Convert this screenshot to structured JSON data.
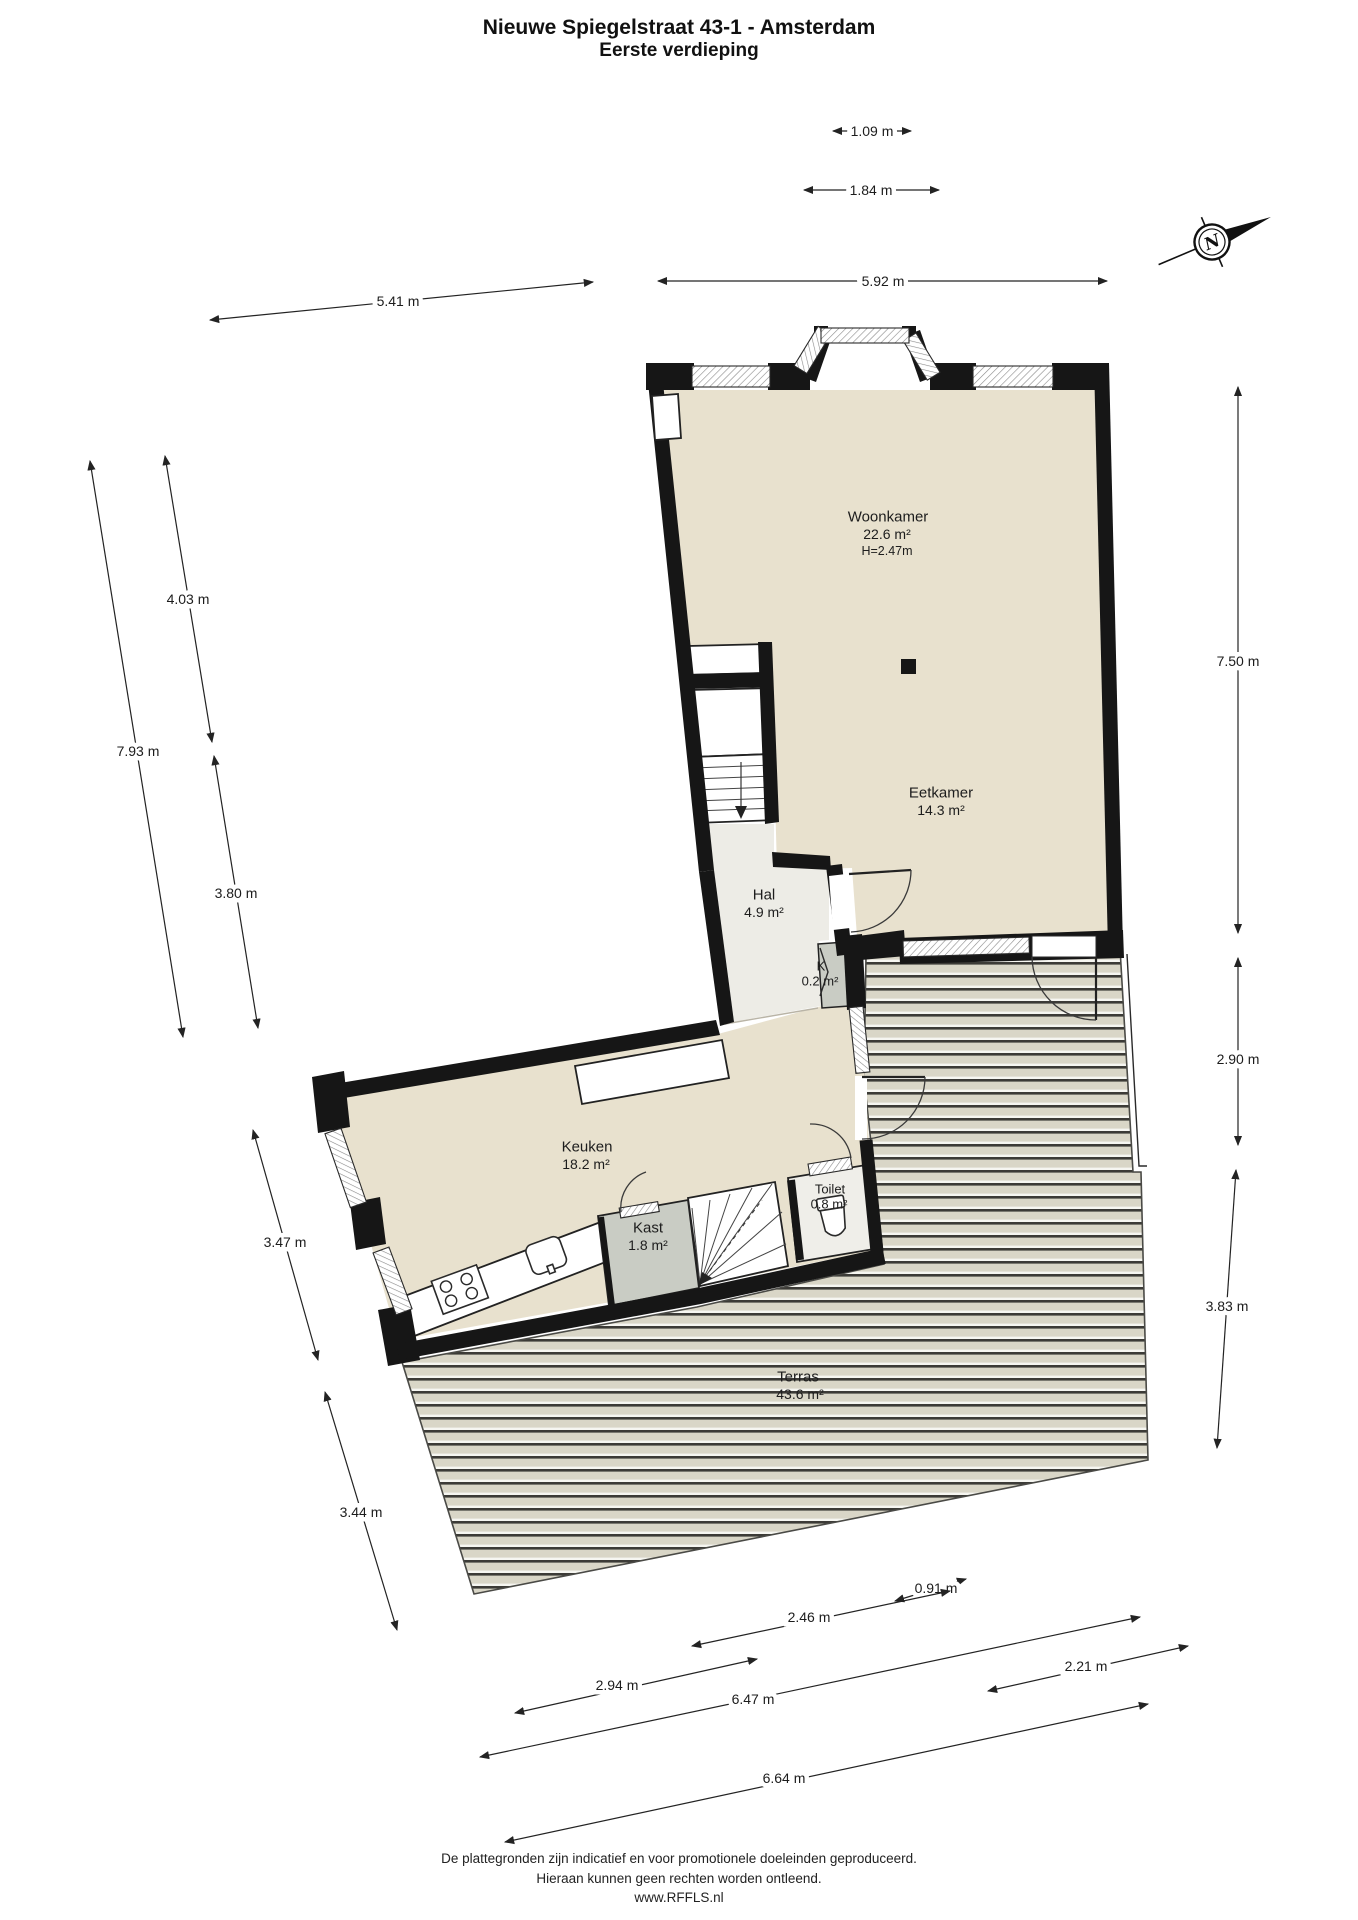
{
  "title": {
    "line1": "Nieuwe Spiegelstraat 43-1 - Amsterdam",
    "line2": "Eerste verdieping"
  },
  "compass": {
    "label": "N"
  },
  "rooms": [
    {
      "name": "Woonkamer",
      "area": "22.6 m²",
      "height": "H=2.47m"
    },
    {
      "name": "Eetkamer",
      "area": "14.3 m²"
    },
    {
      "name": "Hal",
      "area": "4.9 m²"
    },
    {
      "name": "K",
      "area": "0.2 m²"
    },
    {
      "name": "Keuken",
      "area": "18.2 m²"
    },
    {
      "name": "Kast",
      "area": "1.8 m²"
    },
    {
      "name": "Toilet",
      "area": "0.8 m²"
    },
    {
      "name": "Terras",
      "area": "43.6 m²"
    }
  ],
  "dimensions": [
    {
      "label": "1.09 m"
    },
    {
      "label": "1.84 m"
    },
    {
      "label": "5.92 m"
    },
    {
      "label": "5.41 m"
    },
    {
      "label": "4.03 m"
    },
    {
      "label": "7.93 m"
    },
    {
      "label": "3.80 m"
    },
    {
      "label": "7.50 m"
    },
    {
      "label": "2.90 m"
    },
    {
      "label": "3.83 m"
    },
    {
      "label": "3.47 m"
    },
    {
      "label": "3.44 m"
    },
    {
      "label": "0.91 m"
    },
    {
      "label": "2.46 m"
    },
    {
      "label": "2.94 m"
    },
    {
      "label": "6.47 m"
    },
    {
      "label": "2.21 m"
    },
    {
      "label": "6.64 m"
    }
  ],
  "footer": {
    "line1": "De plattegronden zijn indicatief en voor promotionele doeleinden geproduceerd.",
    "line2": "Hieraan kunnen geen rechten worden ontleend.",
    "line3": "www.RFFLS.nl"
  },
  "colors": {
    "room_floor": "#e8e1ce",
    "hall_floor": "#edece6",
    "closet_fill": "#c9ccc4",
    "toilet_floor": "#efeee9",
    "wall": "#161616",
    "terrace_base": "#d9d6c7",
    "terrace_stripe": "#3c3b37",
    "terrace_gap": "#f6f6f1"
  }
}
